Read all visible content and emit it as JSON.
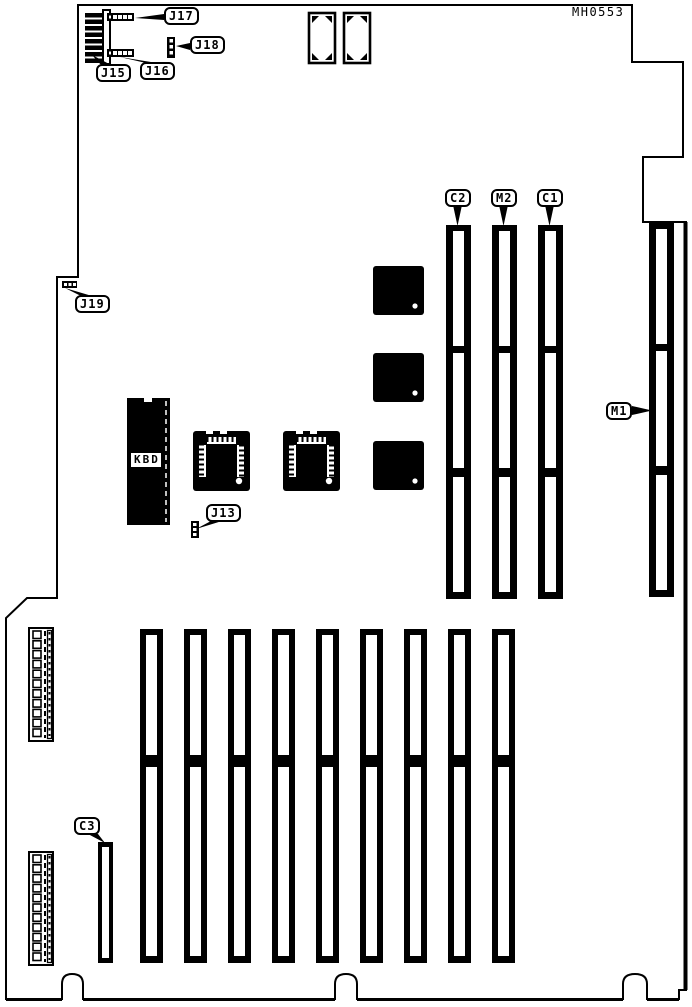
{
  "board": {
    "part_number": "MH0553",
    "type": "circuit-board-layout-diagram",
    "labels": {
      "j13": "J13",
      "j15": "J15",
      "j16": "J16",
      "j17": "J17",
      "j18": "J18",
      "j19": "J19",
      "c1": "C1",
      "c2": "C2",
      "c3": "C3",
      "m1": "M1",
      "m2": "M2",
      "kbd": "KBD"
    },
    "colors": {
      "line": "#000000",
      "background": "#ffffff"
    }
  }
}
